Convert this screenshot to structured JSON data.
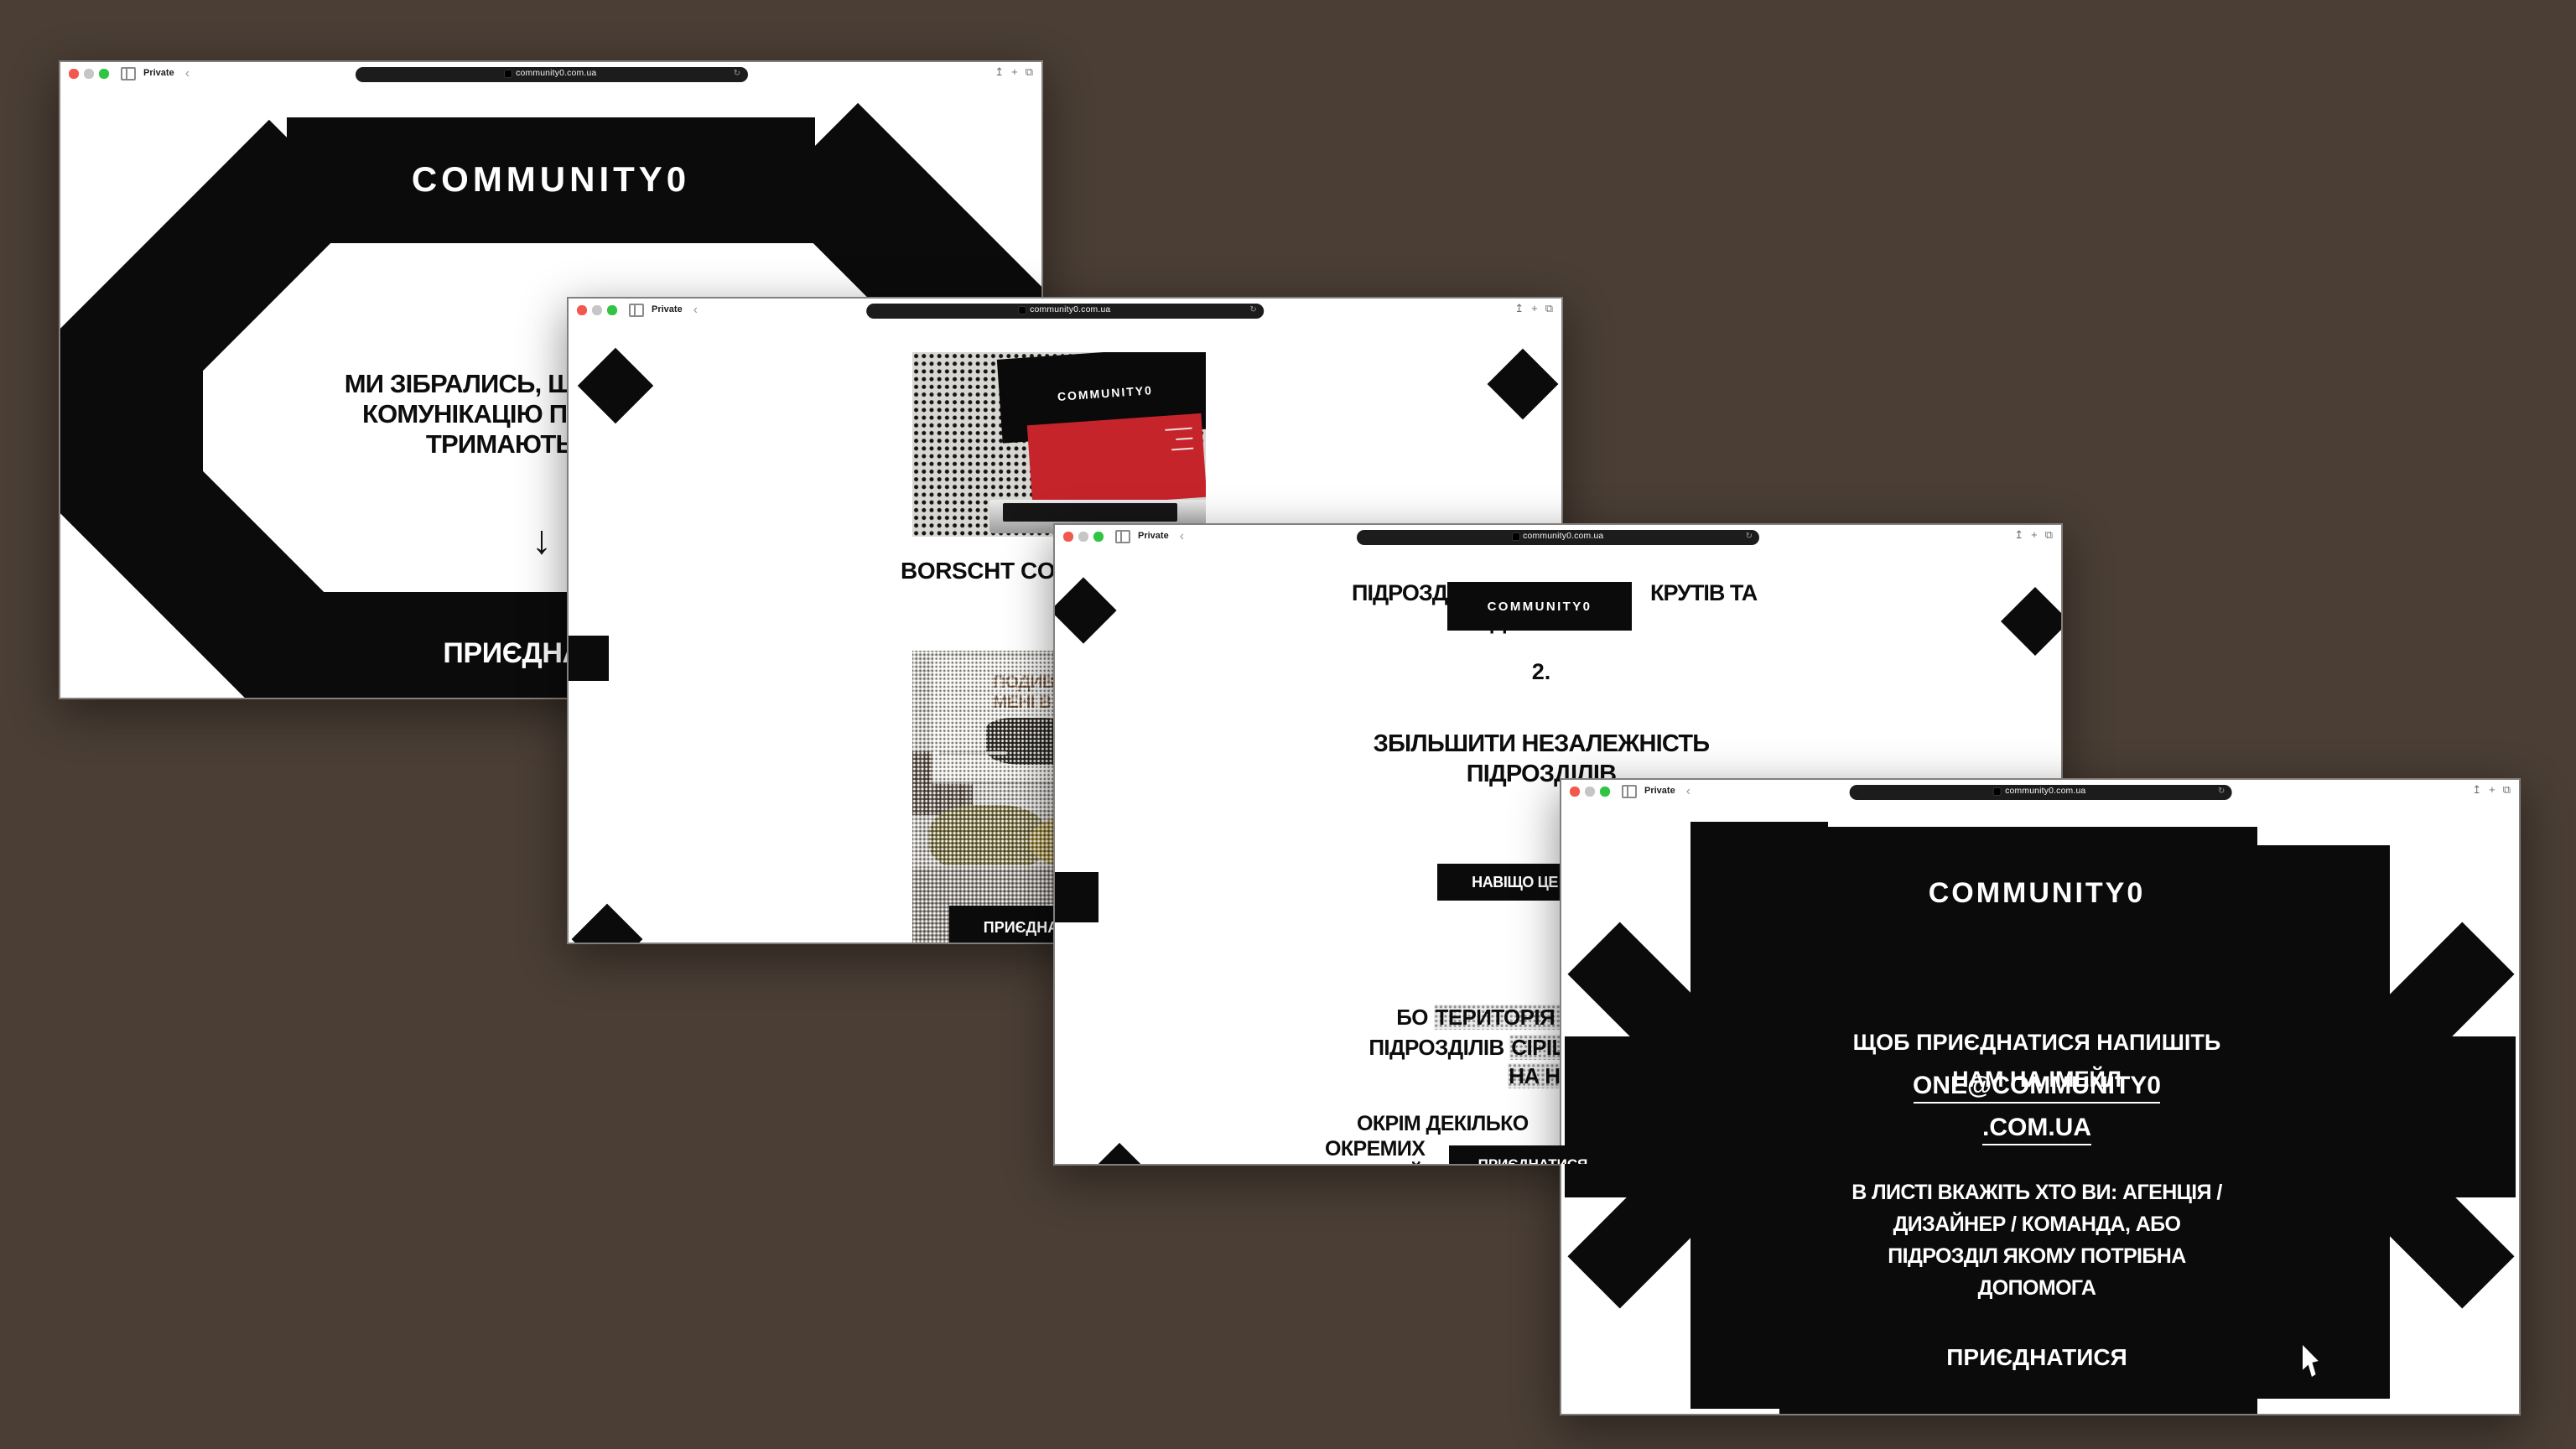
{
  "colors": {
    "desktop_background": "#4a3e35",
    "accent_black": "#0b0b0b",
    "laptop_screen_red": "#c6242b",
    "traffic_lights": [
      "#f2584d",
      "#c6c6c6",
      "#2fc542"
    ]
  },
  "browser": {
    "private_label": "Private",
    "url": "community0.com.ua",
    "back_chevron": "‹",
    "share_icon": "↥",
    "new_tab_icon": "+",
    "tabs_icon": "⧉",
    "reload_icon": "↻"
  },
  "w1": {
    "logo": "COMMUNITY0",
    "heading": [
      "МИ ЗІБРАЛИСЬ, Щ",
      "КОМУНІКАЦІЮ ПІ",
      "ТРИМАЮТЬ"
    ],
    "arrow": "↓",
    "join": "ПРИЄДНАТИСЯ"
  },
  "w2": {
    "laptop_logo": "COMMUNITY0",
    "heading": "BORSCHT CO",
    "billboard": [
      "ПОДИВ",
      "МЕНІ В"
    ],
    "join": "ПРИЄДНАТИСЯ"
  },
  "w3": {
    "heading_left": "ПІДРОЗД",
    "heading_right": "КРУТІВ ТА",
    "heading_hidden": "ДОНАТІВ",
    "logo": "COMMUNITY0",
    "step": "2.",
    "subheading": [
      "ЗБІЛЬШИТИ НЕЗАЛЕЖНІСТЬ",
      "ПІДРОЗДІЛІВ"
    ],
    "why_button": "НАВІЩО ЦЕ ТРЕБА",
    "para1": {
      "l1a": "БО ",
      "l1b": "ТЕРИТОРІЯ К",
      "l2a": "ПІДРОЗДІЛІВ ",
      "l2b": "СІРІШ",
      "l3b": "НА НУ"
    },
    "para2": [
      "ОКРІМ ДЕКІЛЬКО",
      "ОКРЕМИХ",
      "ВІЙСЬКО"
    ],
    "join": "ПРИЄДНАТИСЯ"
  },
  "w4": {
    "logo": "COMMUNITY0",
    "intro": [
      "ЩОБ ПРИЄДНАТИСЯ НАПИШІТЬ",
      "НАМ НА ІМЕЙЛ"
    ],
    "email": [
      "ONE@COMMUNITY0",
      ".COM.UA"
    ],
    "note": [
      "В ЛИСТІ ВКАЖІТЬ ХТО ВИ: АГЕНЦІЯ /",
      "ДИЗАЙНЕР / КОМАНДА, АБО",
      "ПІДРОЗДІЛ ЯКОМУ ПОТРІБНА",
      "ДОПОМОГА"
    ],
    "join": "ПРИЄДНАТИСЯ"
  }
}
